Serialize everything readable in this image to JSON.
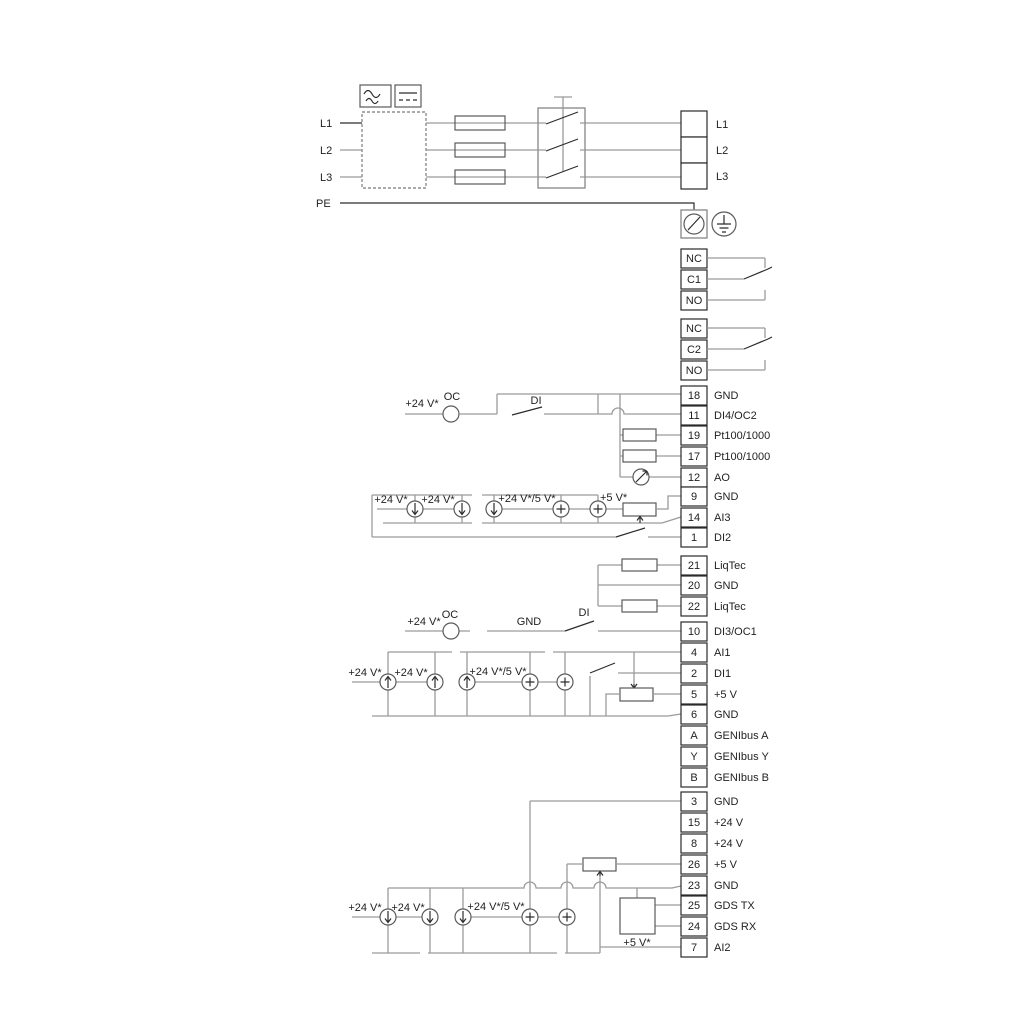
{
  "power_in": {
    "l1": "L1",
    "l2": "L2",
    "l3": "L3",
    "pe": "PE"
  },
  "power_out": {
    "l1": "L1",
    "l2": "L2",
    "l3": "L3"
  },
  "relay1": {
    "nc": "NC",
    "c": "C1",
    "no": "NO"
  },
  "relay2": {
    "nc": "NC",
    "c": "C2",
    "no": "NO"
  },
  "blockA": {
    "rows": [
      {
        "n": "18",
        "l": "GND"
      },
      {
        "n": "11",
        "l": "DI4/OC2"
      },
      {
        "n": "19",
        "l": "Pt100/1000"
      },
      {
        "n": "17",
        "l": "Pt100/1000"
      },
      {
        "n": "12",
        "l": "AO"
      },
      {
        "n": "9",
        "l": "GND"
      },
      {
        "n": "14",
        "l": "AI3"
      },
      {
        "n": "1",
        "l": "DI2"
      }
    ]
  },
  "blockLiqtec": {
    "rows": [
      {
        "n": "21",
        "l": "LiqTec"
      },
      {
        "n": "20",
        "l": "GND"
      },
      {
        "n": "22",
        "l": "LiqTec"
      }
    ]
  },
  "blockB": {
    "rows": [
      {
        "n": "10",
        "l": "DI3/OC1"
      },
      {
        "n": "4",
        "l": "AI1"
      },
      {
        "n": "2",
        "l": "DI1"
      },
      {
        "n": "5",
        "l": "+5 V"
      },
      {
        "n": "6",
        "l": "GND"
      },
      {
        "n": "A",
        "l": "GENIbus A"
      },
      {
        "n": "Y",
        "l": "GENIbus Y"
      },
      {
        "n": "B",
        "l": "GENIbus B"
      }
    ]
  },
  "blockC": {
    "rows": [
      {
        "n": "3",
        "l": "GND"
      },
      {
        "n": "15",
        "l": "+24 V"
      },
      {
        "n": "8",
        "l": "+24 V"
      },
      {
        "n": "26",
        "l": "+5 V"
      },
      {
        "n": "23",
        "l": "GND"
      },
      {
        "n": "25",
        "l": "GDS TX"
      },
      {
        "n": "24",
        "l": "GDS RX"
      },
      {
        "n": "7",
        "l": "AI2"
      }
    ]
  },
  "ann": {
    "v24": "+24 V*",
    "v24_5": "+24 V*/5 V*",
    "v5": "+5 V*",
    "oc": "OC",
    "di": "DI",
    "gnd": "GND"
  },
  "colors": {
    "wire_gray": "#9b9b9b",
    "wire_dark": "#2c2c2c",
    "background": "#ffffff"
  }
}
